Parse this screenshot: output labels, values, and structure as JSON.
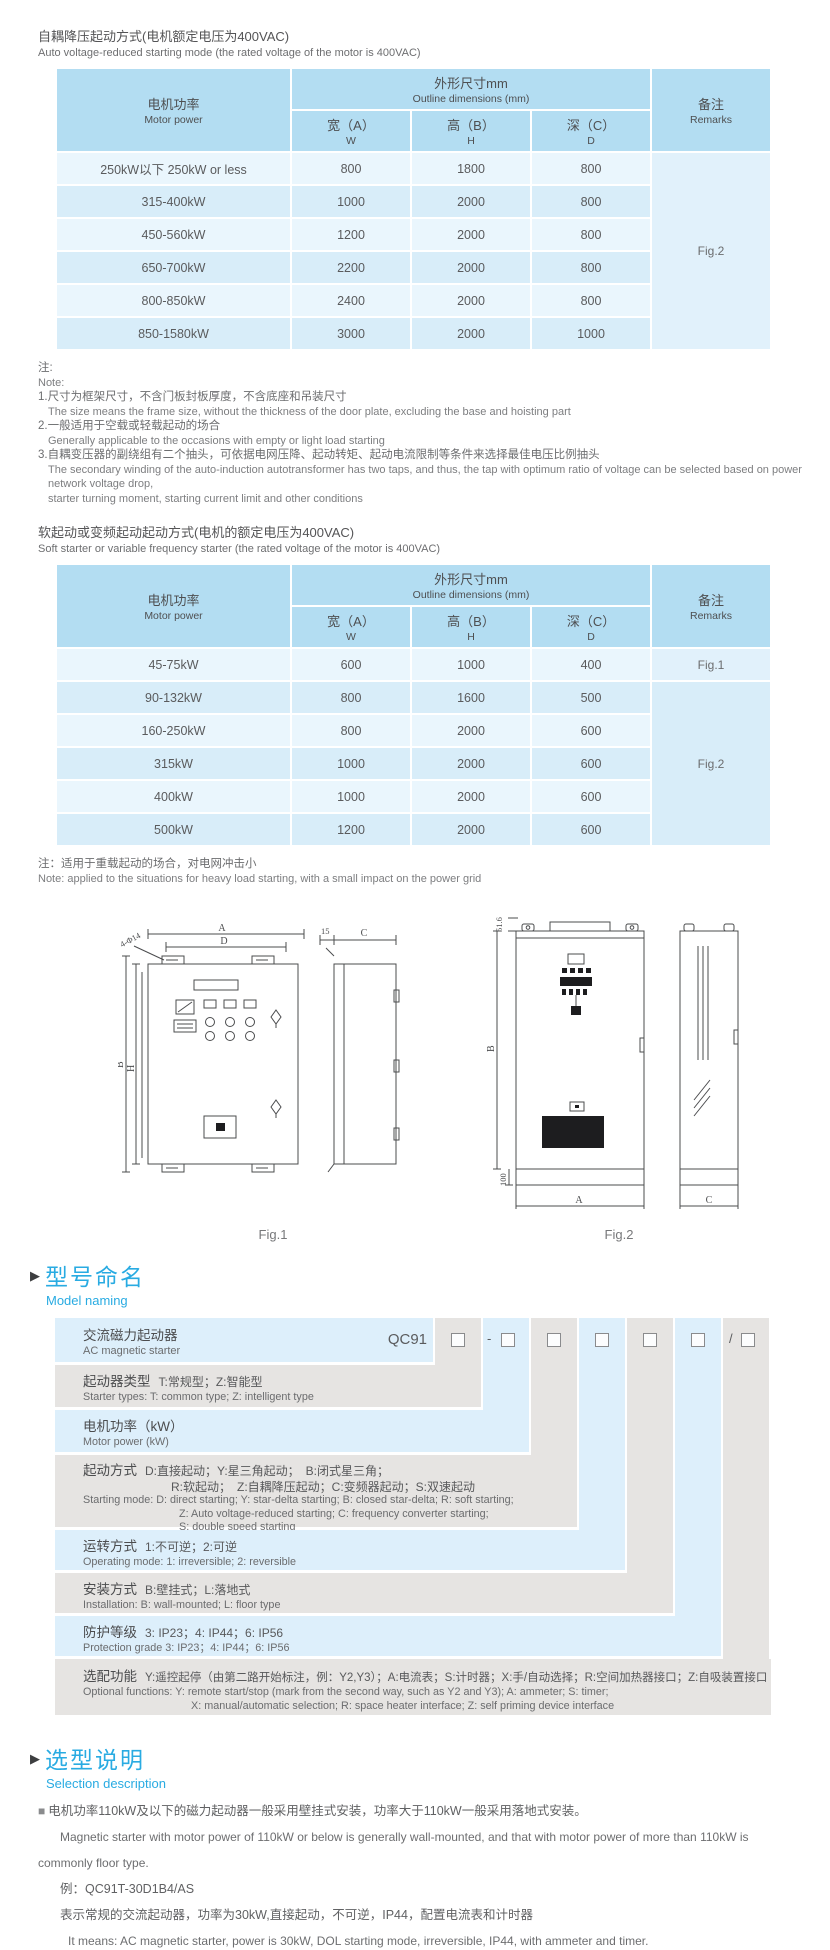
{
  "colors": {
    "accent_blue": "#29abe2",
    "table_header_blue": "#b3ddf2",
    "row_light_blue": "#eaf6fd",
    "row_mid_blue": "#d8edf9",
    "naming_blue": "#ddeffb",
    "naming_grey": "#e6e4e2"
  },
  "section1": {
    "title_zh": "自耦降压起动方式(电机额定电压为400VAC)",
    "title_en": "Auto voltage-reduced starting mode (the rated voltage of the motor is 400VAC)"
  },
  "section2": {
    "title_zh": "软起动或变频起动起动方式(电机的额定电压为400VAC)",
    "title_en": "Soft starter or variable frequency starter (the rated voltage of the motor is 400VAC)"
  },
  "table_header": {
    "motor_zh": "电机功率",
    "motor_en": "Motor power",
    "dims_zh": "外形尺寸mm",
    "dims_en": "Outline dimensions (mm)",
    "w_zh": "宽（A）",
    "w_sub": "W",
    "h_zh": "高（B）",
    "h_sub": "H",
    "d_zh": "深（C）",
    "d_sub": "D",
    "remark_zh": "备注",
    "remark_en": "Remarks"
  },
  "table1": {
    "rows": [
      {
        "power": "250kW以下 250kW or less",
        "w": "800",
        "h": "1800",
        "d": "800"
      },
      {
        "power": "315-400kW",
        "w": "1000",
        "h": "2000",
        "d": "800"
      },
      {
        "power": "450-560kW",
        "w": "1200",
        "h": "2000",
        "d": "800"
      },
      {
        "power": "650-700kW",
        "w": "2200",
        "h": "2000",
        "d": "800"
      },
      {
        "power": "800-850kW",
        "w": "2400",
        "h": "2000",
        "d": "800"
      },
      {
        "power": "850-1580kW",
        "w": "3000",
        "h": "2000",
        "d": "1000"
      }
    ],
    "remark": "Fig.2"
  },
  "notes1": {
    "zh_mark": "注:",
    "en_mark": "Note:",
    "n1_zh": "1.尺寸为框架尺寸，不含门板封板厚度，不含底座和吊装尺寸",
    "n1_en": "The size means the frame size, without the thickness of the door plate, excluding the base and hoisting part",
    "n2_zh": "2.一般适用于空载或轻载起动的场合",
    "n2_en": "Generally applicable to the occasions with empty or light load starting",
    "n3_zh": "3.自耦变压器的副绕组有二个抽头，可依据电网压降、起动转矩、起动电流限制等条件来选择最佳电压比例抽头",
    "n3_en1": "The secondary winding of the auto-induction autotransformer has two taps, and thus, the tap with optimum ratio of voltage can be selected based on power network voltage drop,",
    "n3_en2": "starter turning moment, starting current limit and other conditions"
  },
  "table2": {
    "rows": [
      {
        "power": "45-75kW",
        "w": "600",
        "h": "1000",
        "d": "400"
      },
      {
        "power": "90-132kW",
        "w": "800",
        "h": "1600",
        "d": "500"
      },
      {
        "power": "160-250kW",
        "w": "800",
        "h": "2000",
        "d": "600"
      },
      {
        "power": "315kW",
        "w": "1000",
        "h": "2000",
        "d": "600"
      },
      {
        "power": "400kW",
        "w": "1000",
        "h": "2000",
        "d": "600"
      },
      {
        "power": "500kW",
        "w": "1200",
        "h": "2000",
        "d": "600"
      }
    ],
    "remark_row1": "Fig.1",
    "remark_rest": "Fig.2"
  },
  "note2": {
    "zh": "注：适用于重载起动的场合，对电网冲击小",
    "en": "Note: applied to the situations for heavy load starting, with a small impact on the power grid"
  },
  "figures": {
    "fig1": {
      "label": "Fig.1",
      "dim_a": "A",
      "dim_d": "D",
      "dim_b": "B",
      "dim_h": "H",
      "dim_15": "15",
      "dim_c": "C",
      "holes": "4-Φ14"
    },
    "fig2": {
      "label": "Fig.2",
      "dim_b": "B",
      "dim_a": "A",
      "dim_c": "C",
      "dim_100": "100",
      "dim_516": "51.6"
    }
  },
  "model_naming": {
    "marker": "▶",
    "title_zh": "型号命名",
    "title_en": "Model naming",
    "code": "QC91",
    "box_prefixes": [
      "",
      "-",
      "",
      "",
      "",
      "",
      "/"
    ],
    "rows": [
      {
        "label_zh": "交流磁力起动器",
        "label_en": "AC magnetic starter"
      },
      {
        "label": "起动器类型",
        "opts_zh": "T:常规型；Z:智能型",
        "en1": "Starter types: T: common type; Z: intelligent type"
      },
      {
        "label": "电机功率（kW）",
        "en1": "Motor power (kW)"
      },
      {
        "label": "起动方式",
        "opts_zh": "D:直接起动；Y:星三角起动；　B:闭式星三角；",
        "zh2": "R:软起动；　Z:自耦降压起动；C:变频器起动；S:双速起动",
        "en1": "Starting mode: D: direct starting; Y: star-delta starting; B: closed star-delta; R: soft starting;",
        "en2": "Z: Auto voltage-reduced starting; C: frequency converter starting;",
        "en3": "S: double speed starting"
      },
      {
        "label": "运转方式",
        "opts_zh": "1:不可逆；2:可逆",
        "en1": "Operating mode: 1: irreversible; 2: reversible"
      },
      {
        "label": "安装方式",
        "opts_zh": "B:壁挂式；L:落地式",
        "en1": "Installation: B: wall-mounted; L: floor type"
      },
      {
        "label": "防护等级",
        "opts_zh": "3: IP23；4: IP44；6: IP56",
        "en1": "Protection grade  3: IP23；4: IP44；6: IP56"
      },
      {
        "label": "选配功能",
        "opts_zh": "Y:遥控起停（由第二路开始标注，例：Y2,Y3）；A:电流表；S:计时器；X:手/自动选择；R:空间加热器接口；Z:自吸装置接口",
        "en1": "Optional functions: Y: remote start/stop (mark from the second way, such as Y2 and Y3); A: ammeter; S: timer;",
        "en2": "X: manual/automatic selection; R: space heater interface; Z: self priming device interface"
      }
    ]
  },
  "selection": {
    "marker": "▶",
    "title_zh": "选型说明",
    "title_en": "Selection description",
    "bullet": "■",
    "p1_zh": "电机功率110kW及以下的磁力起动器一般采用壁挂式安装，功率大于110kW一般采用落地式安装。",
    "p1_en1": "Magnetic starter with motor power of 110kW or below is generally wall-mounted, and that with motor power of more than 110kW is",
    "p1_en2": "commonly floor type.",
    "example": "例：QC91T-30D1B4/AS",
    "p2_zh": "表示常规的交流起动器，功率为30kW,直接起动，不可逆，IP44，配置电流表和计时器",
    "p2_en": "It means: AC magnetic starter, power is 30kW, DOL starting mode, irreversible, IP44, with ammeter and timer."
  }
}
